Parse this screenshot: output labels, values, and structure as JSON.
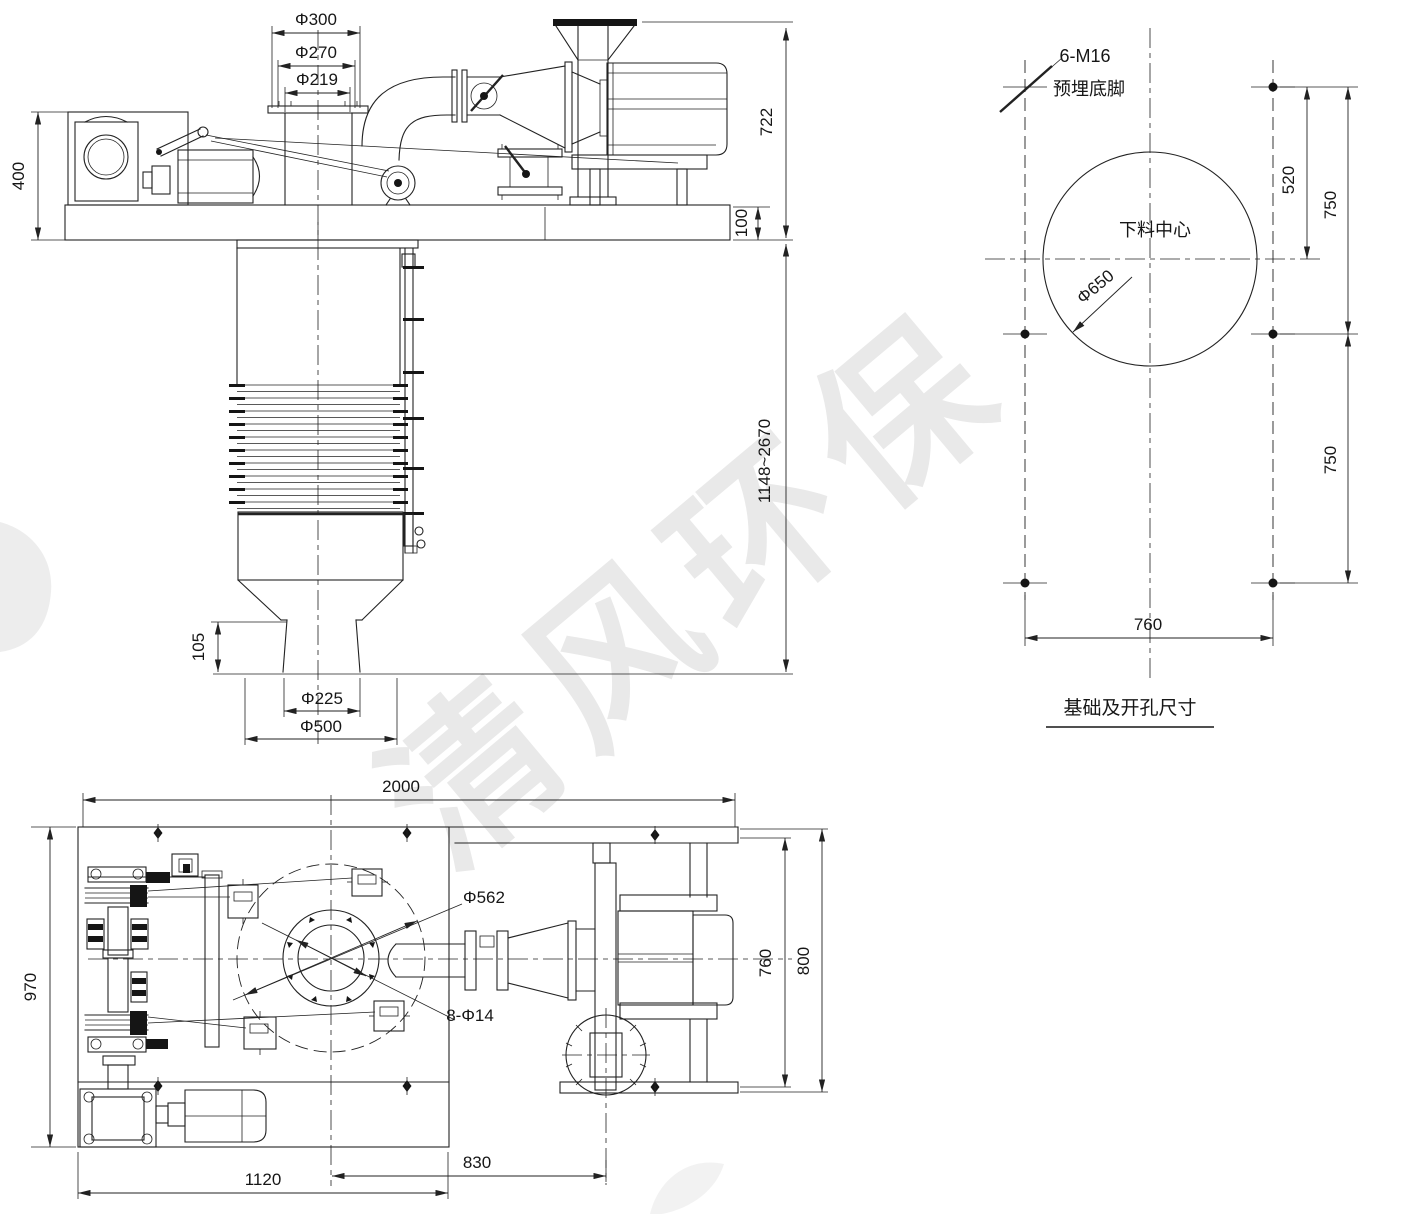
{
  "watermark": {
    "text": "清风环保"
  },
  "front_view": {
    "dims": {
      "inlet_od": "Φ300",
      "inlet_mid": "Φ270",
      "inlet_id": "Φ219",
      "drive_height": "400",
      "fan_height": "722",
      "base_height": "100",
      "body_height_range": "1148~2670",
      "spout_height": "105",
      "outlet_dia": "Φ225",
      "cone_dia": "Φ500"
    }
  },
  "foundation_view": {
    "anchor_spec": "6-M16",
    "anchor_label": "预埋底脚",
    "center_label": "下料中心",
    "opening_dia": "Φ650",
    "dims": {
      "center_offset": "520",
      "row_top": "750",
      "row_bottom": "750",
      "bolt_span": "760"
    },
    "caption": "基础及开孔尺寸"
  },
  "plan_view": {
    "dims": {
      "overall_width": "2000",
      "frame_depth": "970",
      "frame_width": "1120",
      "fan_offset": "830",
      "sweep_dia": "Φ562",
      "bolt_holes": "8-Φ14",
      "fan_frame_depth": "760",
      "fan_frame_overall": "800"
    }
  }
}
